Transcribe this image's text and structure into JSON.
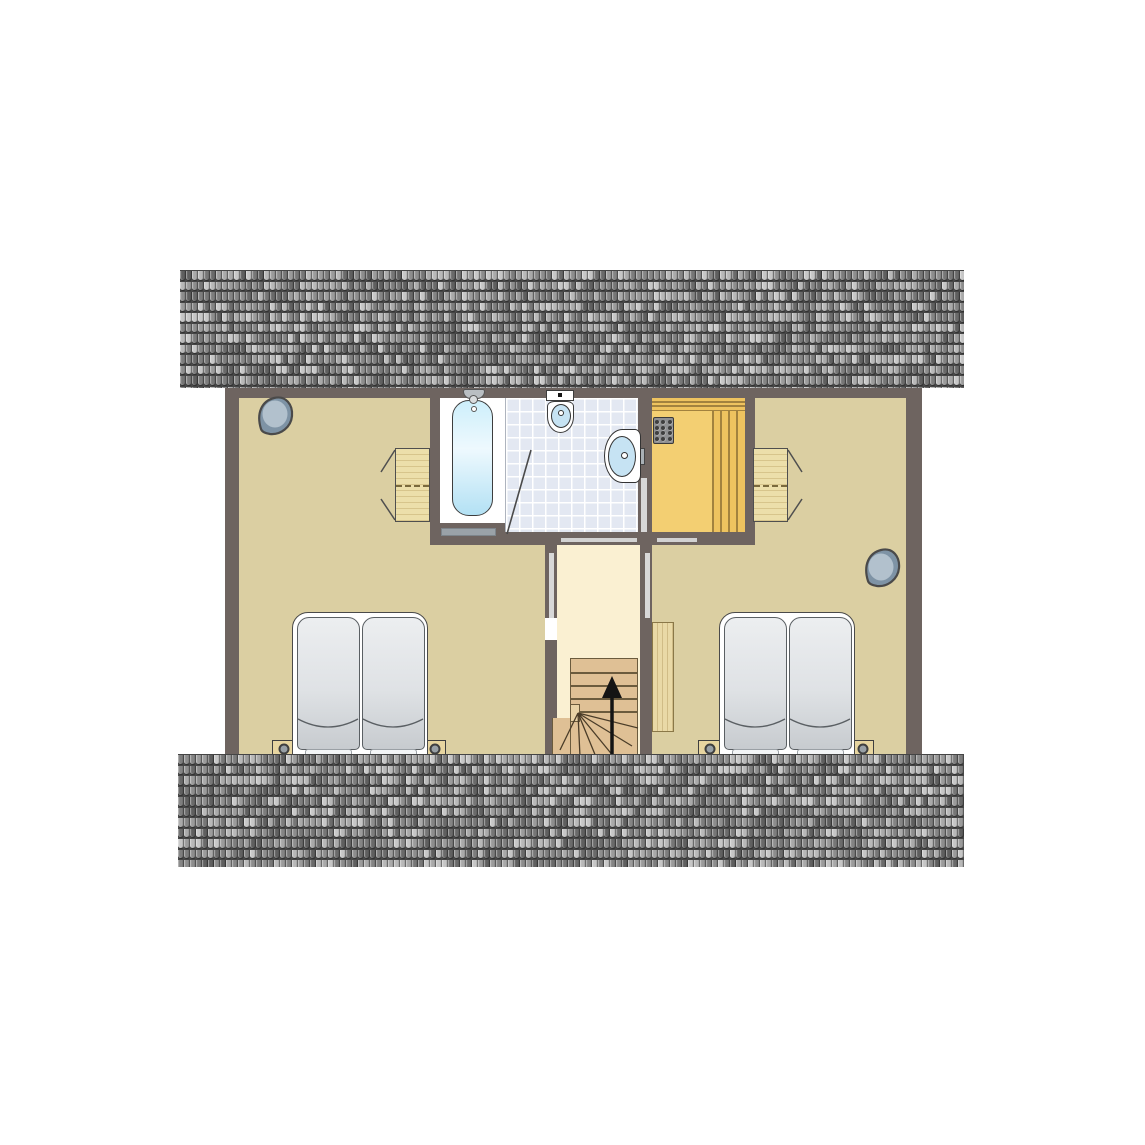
{
  "scene": {
    "kind": "architectural-floor-plan",
    "storey": "attic",
    "background_color": "#ffffff",
    "visible_text": []
  },
  "palette": {
    "wall": "#6e6460",
    "bedroom_floor": "#dbcfa2",
    "hallway_floor": "#faf0d2",
    "bathroom_tile": "#e3e8f2",
    "tile_grout": "#ffffff",
    "sauna_floor": "#f3cf72",
    "sauna_bench": "#eec35f",
    "bench_line": "#a2823e",
    "heater_body": "#8f9092",
    "heater_dot": "#3f3f3f",
    "furniture_wood": "#ecdfaa",
    "closet_wood": "#e9d9a6",
    "stair_wood": "#dfc095",
    "stair_line": "#6b5b3d",
    "bed_frame": "#ffffff",
    "mattress_light": "#eceef0",
    "mattress_dark": "#c7cbcf",
    "nightstand": "#e7d5a0",
    "lamp_center": "#98a0a6",
    "tub_water_light": "#eef9fe",
    "tub_water_dark": "#b3e1f4",
    "porcelain": "#ffffff",
    "basin_water": "#c6e3f3",
    "fixture_outline": "#3d3d3d",
    "threshold": "#d2d2d2",
    "door_stripe": "#d8d8d8",
    "ornament_fill": "#7e93a5",
    "ornament_highlight": "#b2c1cd",
    "ornament_outline": "#4a4a4a",
    "stair_arrow": "#141414"
  },
  "roof": {
    "tile_width": 6,
    "tile_height": 10.5,
    "tile_palette": [
      "#5f5f5f",
      "#6a6a6a",
      "#7d7d7d",
      "#8d8d8d",
      "#9b9b9b",
      "#a9a9a9",
      "#b8b8b8",
      "#c6c6c6",
      "#848484",
      "#767676"
    ],
    "strips": [
      {
        "name": "roof-strip-top",
        "seed": 12345
      },
      {
        "name": "roof-strip-bottom",
        "seed": 54321
      }
    ]
  },
  "rooms": [
    {
      "name": "bedroom-left",
      "beds": 2,
      "furniture": [
        "wardrobe",
        "nightstand-with-lamp",
        "nightstand-with-lamp",
        "wall-ornament"
      ]
    },
    {
      "name": "bathroom",
      "fixtures": [
        "bathtub",
        "toilet",
        "washbasin",
        "door-swing"
      ]
    },
    {
      "name": "sauna",
      "fixtures": [
        "sauna-heater",
        "bench-planks"
      ]
    },
    {
      "name": "bedroom-right",
      "beds": 2,
      "furniture": [
        "wardrobe",
        "closet",
        "nightstand-with-lamp",
        "nightstand-with-lamp",
        "wall-ornament"
      ]
    },
    {
      "name": "stairwell-hallway",
      "fixtures": [
        "staircase-up",
        "direction-arrow-up",
        "winder-steps"
      ]
    }
  ],
  "heater": {
    "dot_cols": 3,
    "dot_rows": 4
  }
}
